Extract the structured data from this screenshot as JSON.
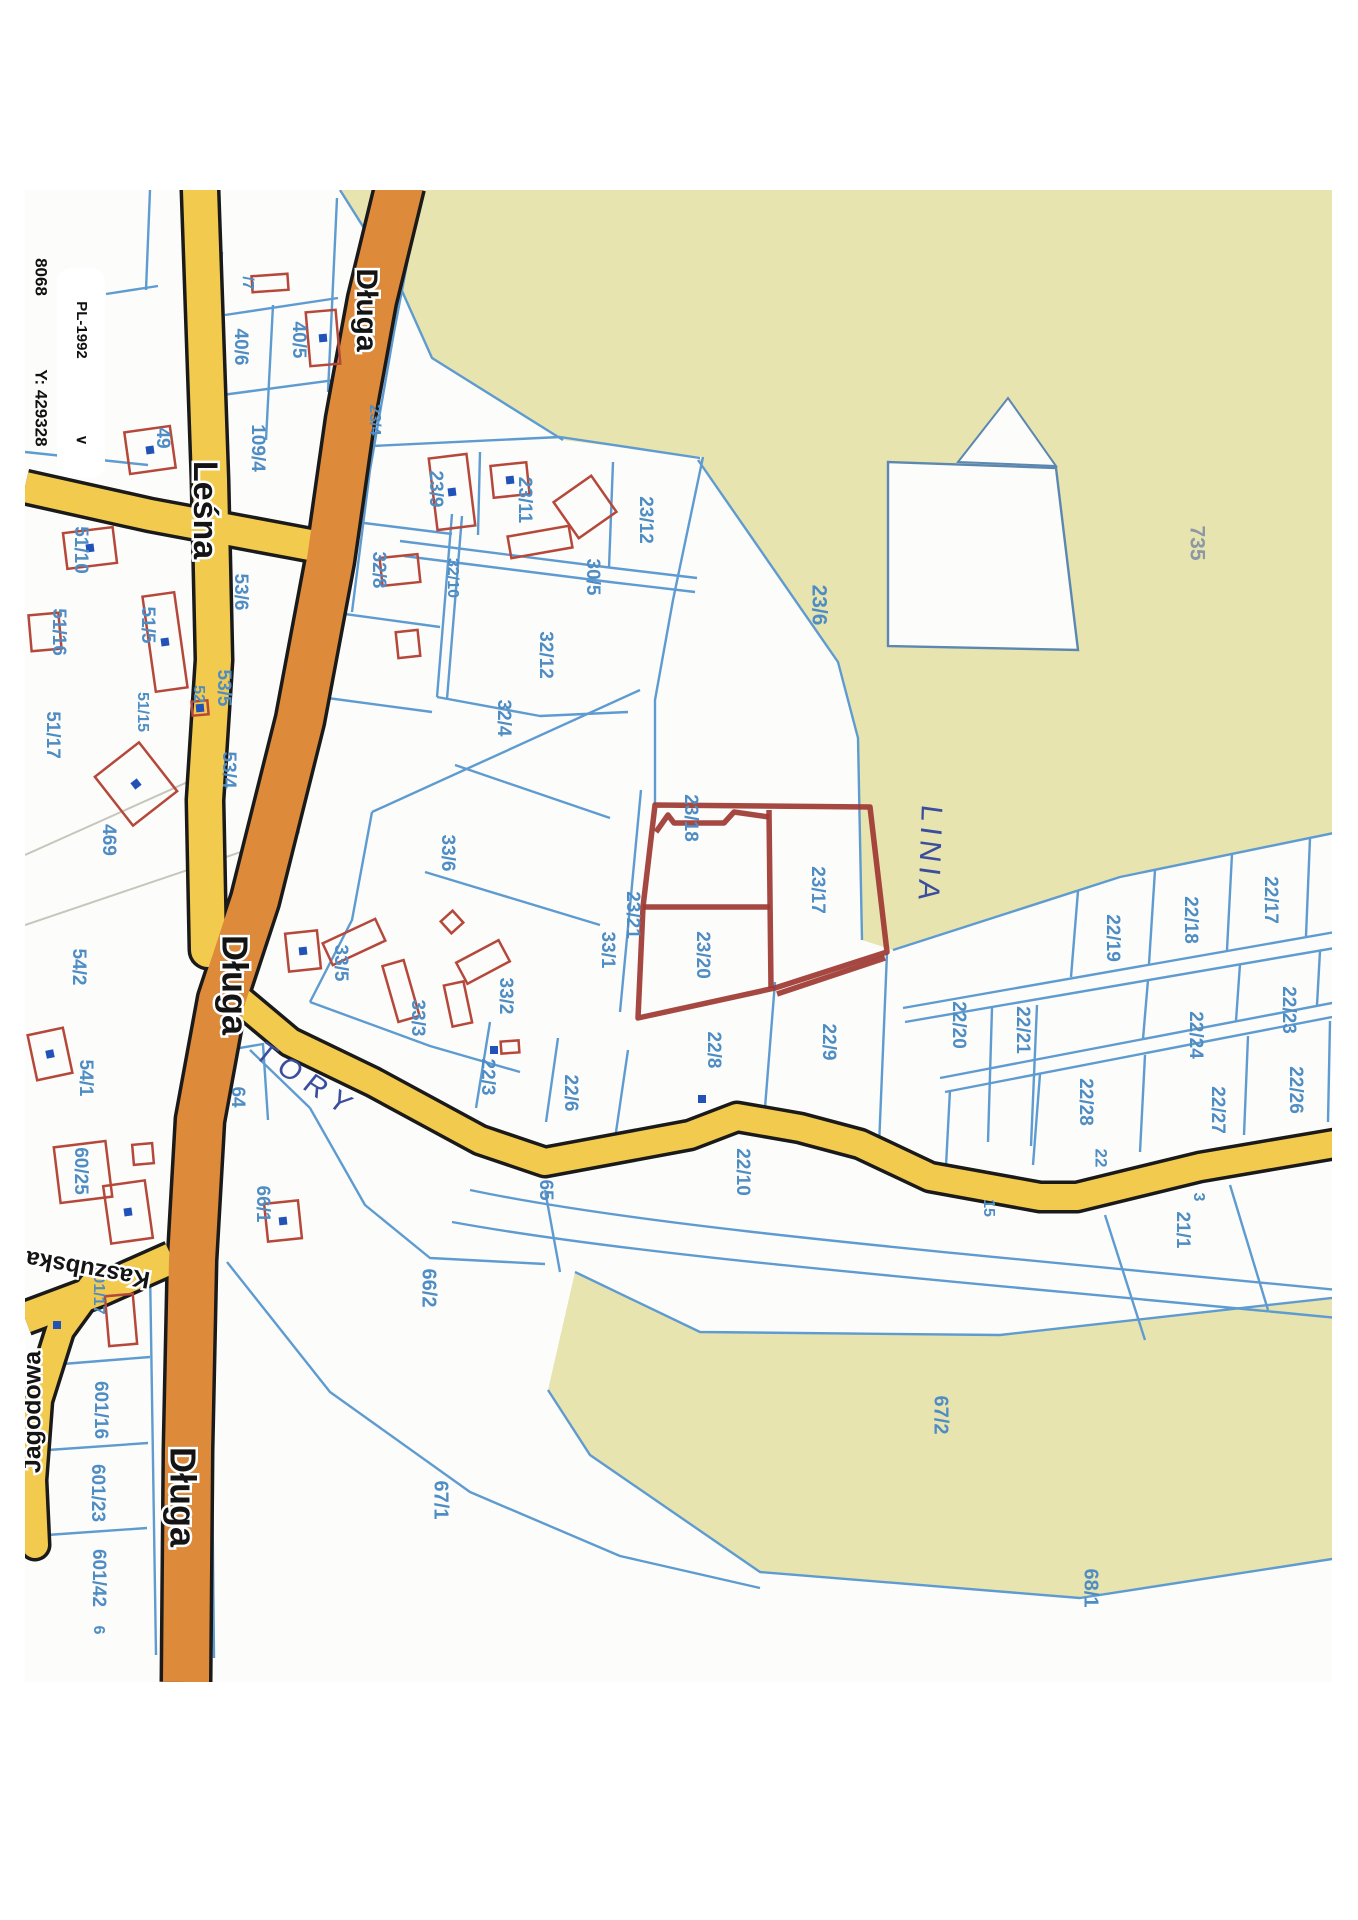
{
  "document_type": "scanned cadastral map print",
  "margin_ui": {
    "coord_x_partial": "8068",
    "coord_y": "Y: 429328",
    "crs_selector": "PL-1992",
    "chevron": "∨"
  },
  "road_names": [
    "Długa",
    "Leśna",
    "Kaszubska",
    "Jagodowa"
  ],
  "handwritten_annotations": [
    "LINIA",
    "TORY"
  ],
  "highlighted_parcels": [
    "23/18",
    "23/20",
    "23/17"
  ],
  "colors": {
    "map_bg": "#fcfcfa",
    "olive": "#e8e4b0",
    "blue_line": "#5e9bd0",
    "label_blue": "#4e8cc4",
    "road_yellow": "#f2ca4d",
    "road_orange": "#de8a3b",
    "road_casing": "#1a1a1a",
    "red_marker": "#9e3832",
    "building_red": "#b5483a",
    "dot_navy": "#2152b8",
    "pen_blue": "#3b4d9e",
    "scan_gray": "#c6c6bc"
  },
  "map": {
    "labels": [
      {
        "t": "/7",
        "x": 247,
        "y": 283,
        "s": 16
      },
      {
        "t": "40/5",
        "x": 298,
        "y": 340
      },
      {
        "t": "40/6",
        "x": 240,
        "y": 347
      },
      {
        "t": "109/4",
        "x": 257,
        "y": 448
      },
      {
        "t": "49",
        "x": 162,
        "y": 438
      },
      {
        "t": "23/9",
        "x": 435,
        "y": 489
      },
      {
        "t": "23/11",
        "x": 524,
        "y": 500
      },
      {
        "t": "23/12",
        "x": 645,
        "y": 520
      },
      {
        "t": "30/5",
        "x": 592,
        "y": 577
      },
      {
        "t": "23/4",
        "x": 374,
        "y": 420,
        "s": 16
      },
      {
        "t": "32/8",
        "x": 378,
        "y": 570
      },
      {
        "t": "32/10",
        "x": 452,
        "y": 578,
        "s": 16
      },
      {
        "t": "32/12",
        "x": 545,
        "y": 655
      },
      {
        "t": "32/4",
        "x": 503,
        "y": 718
      },
      {
        "t": "23/6",
        "x": 818,
        "y": 605,
        "s": 21
      },
      {
        "t": "735",
        "x": 1196,
        "y": 543,
        "s": 21,
        "c": "gray-label"
      },
      {
        "t": "51/10",
        "x": 80,
        "y": 550
      },
      {
        "t": "53/6",
        "x": 240,
        "y": 592
      },
      {
        "t": "51/16",
        "x": 58,
        "y": 632
      },
      {
        "t": "51/5",
        "x": 147,
        "y": 625
      },
      {
        "t": "53/5",
        "x": 223,
        "y": 688
      },
      {
        "t": "52",
        "x": 198,
        "y": 694,
        "s": 16
      },
      {
        "t": "51/15",
        "x": 142,
        "y": 712,
        "s": 16
      },
      {
        "t": "51/17",
        "x": 52,
        "y": 735
      },
      {
        "t": "53/4",
        "x": 228,
        "y": 770
      },
      {
        "t": "469",
        "x": 108,
        "y": 840
      },
      {
        "t": "54/2",
        "x": 78,
        "y": 967
      },
      {
        "t": "54/1",
        "x": 85,
        "y": 1078
      },
      {
        "t": "60/25",
        "x": 80,
        "y": 1171
      },
      {
        "t": "64",
        "x": 237,
        "y": 1097
      },
      {
        "t": "601/17",
        "x": 98,
        "y": 1290,
        "s": 16
      },
      {
        "t": "601/16",
        "x": 100,
        "y": 1410
      },
      {
        "t": "601/23",
        "x": 97,
        "y": 1493
      },
      {
        "t": "601/42",
        "x": 98,
        "y": 1578
      },
      {
        "t": "6",
        "x": 98,
        "y": 1630,
        "s": 16
      },
      {
        "t": "33/6",
        "x": 447,
        "y": 853
      },
      {
        "t": "33/5",
        "x": 340,
        "y": 963
      },
      {
        "t": "33/3",
        "x": 417,
        "y": 1018
      },
      {
        "t": "33/2",
        "x": 505,
        "y": 996
      },
      {
        "t": "33/1",
        "x": 607,
        "y": 950
      },
      {
        "t": "23/21",
        "x": 632,
        "y": 915
      },
      {
        "t": "23/18",
        "x": 690,
        "y": 818
      },
      {
        "t": "23/17",
        "x": 817,
        "y": 890
      },
      {
        "t": "23/20",
        "x": 702,
        "y": 955
      },
      {
        "t": "22/8",
        "x": 713,
        "y": 1050
      },
      {
        "t": "22/9",
        "x": 828,
        "y": 1042
      },
      {
        "t": "22/3",
        "x": 487,
        "y": 1077
      },
      {
        "t": "22/6",
        "x": 570,
        "y": 1093
      },
      {
        "t": "65",
        "x": 545,
        "y": 1190
      },
      {
        "t": "22/10",
        "x": 742,
        "y": 1172
      },
      {
        "t": "66/1",
        "x": 262,
        "y": 1204
      },
      {
        "t": "66/2",
        "x": 428,
        "y": 1288,
        "s": 20
      },
      {
        "t": "67/1",
        "x": 440,
        "y": 1500,
        "s": 20
      },
      {
        "t": "67/2",
        "x": 940,
        "y": 1415,
        "s": 20
      },
      {
        "t": "68/1",
        "x": 1090,
        "y": 1588,
        "s": 20
      },
      {
        "t": "21/1",
        "x": 1182,
        "y": 1230
      },
      {
        "t": "3",
        "x": 1198,
        "y": 1197,
        "s": 16
      },
      {
        "t": "15",
        "x": 988,
        "y": 1208,
        "s": 16
      },
      {
        "t": "22/19",
        "x": 1112,
        "y": 938
      },
      {
        "t": "22/18",
        "x": 1190,
        "y": 920
      },
      {
        "t": "22/17",
        "x": 1270,
        "y": 900
      },
      {
        "t": "22/23",
        "x": 1288,
        "y": 1010
      },
      {
        "t": "22/24",
        "x": 1195,
        "y": 1035
      },
      {
        "t": "22/21",
        "x": 1022,
        "y": 1030
      },
      {
        "t": "22/20",
        "x": 958,
        "y": 1025
      },
      {
        "t": "22/28",
        "x": 1085,
        "y": 1102
      },
      {
        "t": "22/27",
        "x": 1217,
        "y": 1110
      },
      {
        "t": "22/26",
        "x": 1295,
        "y": 1090
      },
      {
        "t": "22",
        "x": 1100,
        "y": 1158,
        "s": 17
      }
    ],
    "road_labels": [
      {
        "t": "Leśna",
        "x": 203,
        "y": 510,
        "r": 90,
        "s": 34
      },
      {
        "t": "Długa",
        "x": 365,
        "y": 310,
        "r": 90,
        "s": 30
      },
      {
        "t": "Długa",
        "x": 232,
        "y": 985,
        "r": 90,
        "s": 36
      },
      {
        "t": "Długa",
        "x": 180,
        "y": 1497,
        "r": 90,
        "s": 36
      },
      {
        "t": "Kaszubska",
        "x": 88,
        "y": 1268,
        "r": 190,
        "s": 24
      },
      {
        "t": "Jagodowa",
        "x": 34,
        "y": 1412,
        "r": -90,
        "s": 25
      }
    ],
    "annotations": [
      {
        "t": "LINIA",
        "x": 928,
        "y": 855,
        "r": 92,
        "s": 30,
        "ls": 5
      },
      {
        "t": "TORY",
        "x": 306,
        "y": 1082,
        "r": 33,
        "s": 29,
        "ls": 9
      }
    ],
    "geometry": {
      "olive": [
        "340,190 1358,190 1358,828 1120,877 893,950 862,940 858,738 838,662 698,460 703,457 563,440 432,358 398,282",
        "575,1272 700,1332 1000,1335 1358,1295 1358,1555 1080,1598 760,1572 590,1455 548,1390"
      ],
      "notch": "888,462 1056,468 1078,650 888,646",
      "wedge": "958,462 1056,466 1008,398",
      "scan_lines": [
        "M25,855 L210,772",
        "M25,925 L300,832"
      ],
      "blue_lines": [
        "M106,294 L158,286",
        "M150,190 L146,290",
        "M25,452 L148,465",
        "M225,315 L338,298",
        "M273,305 L266,440",
        "M222,252 L218,315",
        "M222,395 L350,378",
        "M337,198 L328,392",
        "M415,222 L394,332 L370,470 L352,612",
        "M372,446 L560,437",
        "M560,437 L700,458",
        "M480,452 L478,535",
        "M613,462 L609,568",
        "M400,541 L613,568 L697,578",
        "M404,556 L610,582 L695,592",
        "M452,514 L437,697",
        "M462,516 L447,699",
        "M340,520 L452,534",
        "M330,612 L440,627",
        "M320,697 L432,712",
        "M437,697 L540,716 L628,712",
        "M372,812 L640,690",
        "M703,457 L673,600 L655,700 L655,805",
        "M641,790 L620,1012",
        "M372,812 L352,920 L310,1002",
        "M310,1002 L430,1046 L520,1072",
        "M455,765 L610,818",
        "M425,872 L600,925",
        "M490,1022 L476,1108",
        "M558,1038 L546,1122",
        "M628,1050 L616,1132",
        "M775,982 L763,1133",
        "M887,953 L878,1170",
        "M992,1008 L988,1142",
        "M1037,1005 L1031,1146",
        "M893,950 L1120,877 L1358,828",
        "M903,1008 L1358,928",
        "M905,1022 L1358,944",
        "M940,1078 L1358,998",
        "M945,1092 L1358,1012",
        "M1078,891 L1071,977",
        "M1155,870 L1149,964",
        "M1232,854 L1227,950",
        "M1310,838 L1306,936",
        "M1148,980 L1143,1039",
        "M1240,964 L1236,1021",
        "M1320,951 L1317,1005",
        "M1040,1074 L1033,1165",
        "M1145,1055 L1140,1152",
        "M1248,1036 L1244,1135",
        "M1330,1021 L1328,1122",
        "M950,1090 L945,1185",
        "M1105,1215 L1145,1340",
        "M1230,1185 L1268,1310",
        "M470,1190 C650,1228 950,1252 1358,1292",
        "M452,1222 C650,1258 950,1280 1358,1320",
        "M310,1108 L365,1205 L430,1258 L545,1264",
        "M250,1050 L310,1108",
        "M545,1190 L560,1272",
        "M227,1262 L330,1392 L470,1492 L620,1556 L760,1588",
        "M216,1052 L263,1044 L268,1120",
        "M50,1365 L150,1357",
        "M48,1450 L148,1443",
        "M47,1535 L147,1528",
        "M150,1268 L156,1655",
        "M210,1262 L214,1658",
        "M340,190 L398,282",
        "M398,282 L432,358 L563,440",
        "M698,460 L838,662 L858,738 L862,940",
        "M575,1272 L700,1332 L1000,1335 L1358,1295",
        "M1358,1555 L1080,1598 L760,1572 L590,1455 L548,1390"
      ],
      "roads": [
        {
          "name": "lesna-branch",
          "color": "road_yellow",
          "w": 30,
          "d": "M25,487 L150,515 L310,545"
        },
        {
          "name": "lesna",
          "color": "road_yellow",
          "w": 34,
          "cap": "round",
          "d": "M200,190 L210,480 L214,660 L205,800 L208,950"
        },
        {
          "name": "kaszubska",
          "color": "road_yellow",
          "w": 30,
          "d": "M25,1318 L100,1290 L172,1258"
        },
        {
          "name": "jagodowa",
          "color": "road_yellow",
          "w": 26,
          "cap": "round",
          "d": "M92,1286 L60,1330 L38,1400 L32,1480 L35,1545"
        },
        {
          "name": "railway-tory",
          "color": "road_yellow",
          "w": 26,
          "d": "M222,985 L290,1042 L373,1082 L480,1140 L545,1162 L690,1135 L737,1117 L800,1128 L860,1144 L930,1177 L1040,1197 L1077,1197 L1200,1167 L1358,1140"
        },
        {
          "name": "dluga",
          "color": "road_orange",
          "w": 46,
          "d": "M400,185 L372,300 L350,420 L330,560 L300,720 L255,900 L222,1000 L200,1120 L192,1260 L188,1450 L186,1682"
        }
      ],
      "red_marker": [
        "M655,805 L870,807 L887,952 L775,988 L638,1018 L643,907 Z",
        "M885,958 L777,994",
        "M769,810 L771,988",
        "M643,907 L770,907",
        "M656,832 L668,815 L674,823 L724,823 L734,812 L769,817"
      ],
      "buildings": [
        [
          270,
          283,
          36,
          16,
          -4,
          0
        ],
        [
          323,
          338,
          30,
          54,
          -5,
          1
        ],
        [
          150,
          450,
          46,
          42,
          -8,
          1
        ],
        [
          452,
          492,
          38,
          72,
          -7,
          1
        ],
        [
          510,
          480,
          36,
          32,
          -6,
          1
        ],
        [
          585,
          507,
          46,
          44,
          -35,
          0
        ],
        [
          540,
          542,
          62,
          22,
          -10,
          0
        ],
        [
          400,
          570,
          38,
          28,
          -6,
          0
        ],
        [
          408,
          644,
          22,
          26,
          -6,
          0
        ],
        [
          90,
          548,
          50,
          36,
          -7,
          1
        ],
        [
          45,
          632,
          30,
          36,
          -5,
          0
        ],
        [
          165,
          642,
          32,
          96,
          -8,
          1
        ],
        [
          200,
          708,
          16,
          14,
          -5,
          1
        ],
        [
          136,
          784,
          56,
          62,
          -38,
          1
        ],
        [
          50,
          1054,
          36,
          46,
          -12,
          1
        ],
        [
          303,
          951,
          32,
          38,
          -6,
          1
        ],
        [
          354,
          942,
          58,
          24,
          -25,
          0
        ],
        [
          401,
          991,
          22,
          58,
          -16,
          0
        ],
        [
          452,
          922,
          16,
          16,
          -42,
          0
        ],
        [
          483,
          962,
          48,
          24,
          -28,
          0
        ],
        [
          458,
          1004,
          20,
          42,
          -12,
          0
        ],
        [
          83,
          1172,
          52,
          56,
          -7,
          0
        ],
        [
          143,
          1154,
          20,
          20,
          -5,
          0
        ],
        [
          128,
          1212,
          42,
          58,
          -8,
          1
        ],
        [
          283,
          1221,
          34,
          38,
          -6,
          1
        ],
        [
          121,
          1320,
          28,
          50,
          -5,
          0
        ],
        [
          510,
          1047,
          18,
          12,
          -4,
          0
        ]
      ],
      "dots": [
        [
          702,
          1099
        ],
        [
          494,
          1050
        ],
        [
          57,
          1325
        ]
      ]
    }
  }
}
